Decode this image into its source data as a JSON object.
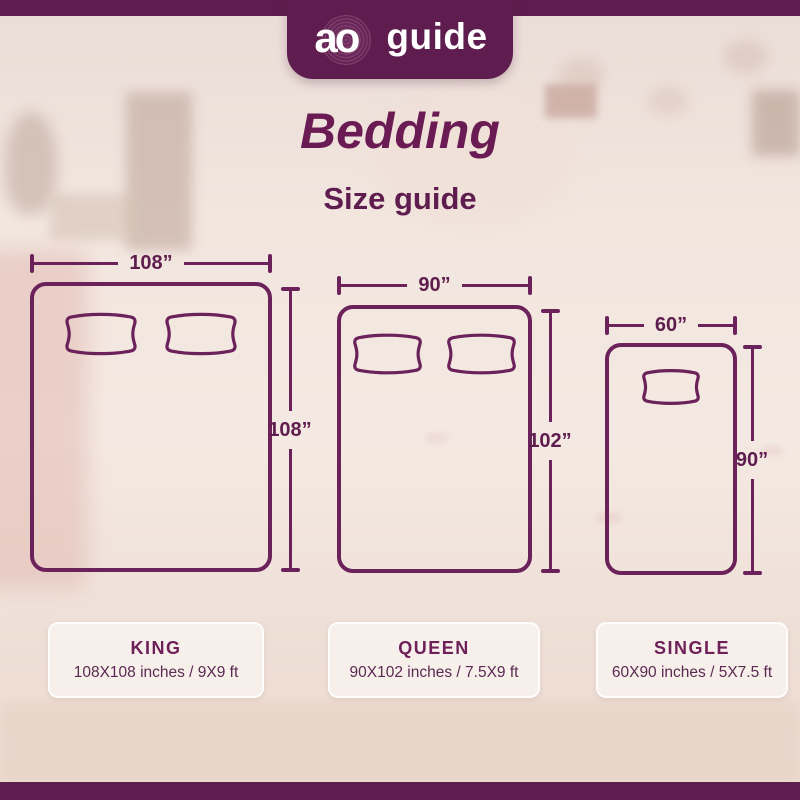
{
  "colors": {
    "accent": "#5e1d4e",
    "line": "#6b2159",
    "title": "#6b1b53",
    "cardtext": "#5a2a52"
  },
  "logo": {
    "brand": "ao",
    "name": "guide"
  },
  "header": {
    "title": "Bedding",
    "subtitle": "Size guide"
  },
  "beds": [
    {
      "id": "king",
      "name": "KING",
      "width_label": "108”",
      "height_label": "108”",
      "details": "108X108 inches / 9X9 ft",
      "pillows": 2
    },
    {
      "id": "queen",
      "name": "QUEEN",
      "width_label": "90”",
      "height_label": "102”",
      "details": "90X102 inches / 7.5X9 ft",
      "pillows": 2
    },
    {
      "id": "single",
      "name": "SINGLE",
      "width_label": "60”",
      "height_label": "90”",
      "details": "60X90 inches / 5X7.5 ft",
      "pillows": 1
    }
  ]
}
